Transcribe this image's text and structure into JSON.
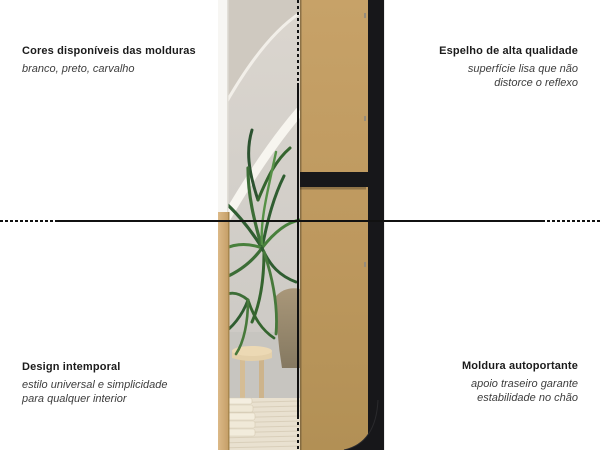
{
  "colors": {
    "ink": "#111111",
    "title_text": "#1b1b1b",
    "subtitle_text": "#3d3d3d",
    "mdf_board": "#c09c61",
    "frame_black": "#17171a",
    "oak_frame": "#d2ab77",
    "wall_greige": "#d7d3cc",
    "plant_green": "#3c6d36",
    "rug_cream": "#e9e1d0"
  },
  "annotations": {
    "top_left": {
      "title": "Cores disponíveis das molduras",
      "subtitle_lines": [
        "branco, preto, carvalho"
      ]
    },
    "top_right": {
      "title": "Espelho de alta qualidade",
      "subtitle_lines": [
        "superfície lisa que não",
        "distorce o reflexo"
      ]
    },
    "bottom_left": {
      "title": "Design intemporal",
      "subtitle_lines": [
        "estilo universal e simplicidade",
        "para qualquer interior"
      ]
    },
    "bottom_right": {
      "title": "Moldura autoportante",
      "subtitle_lines": [
        "apoio traseiro garante",
        "estabilidade no chão"
      ]
    }
  }
}
